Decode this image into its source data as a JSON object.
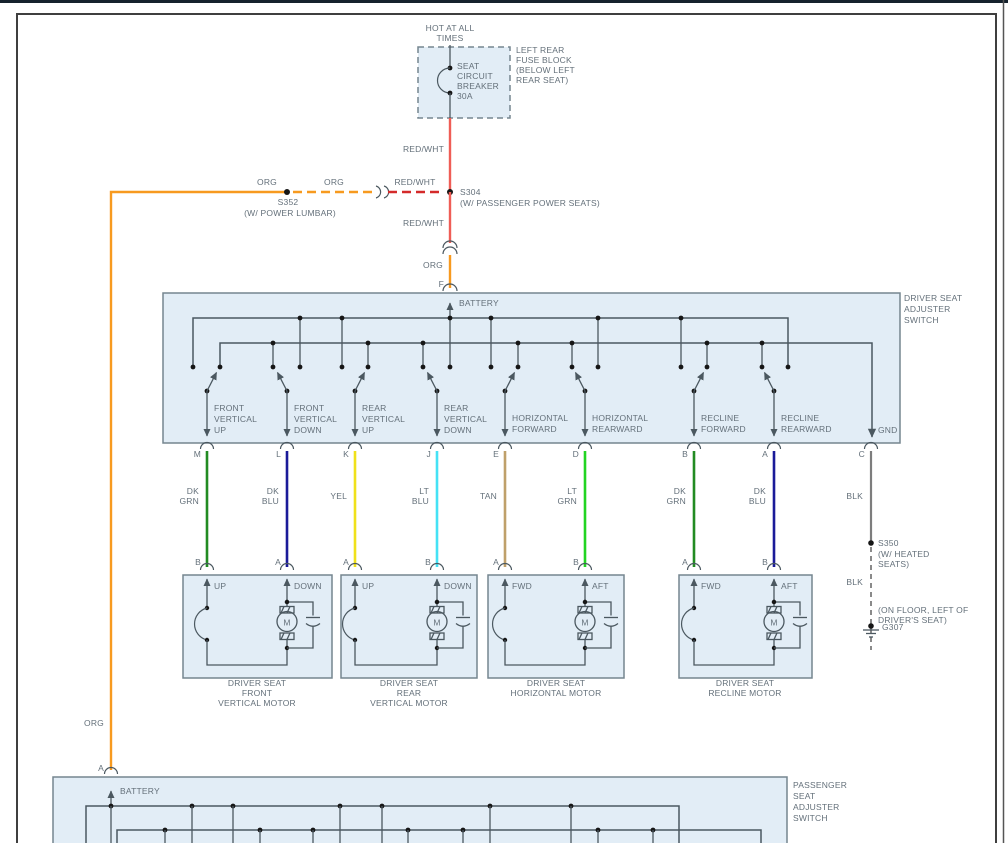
{
  "window": {
    "strip_color": "#15222d",
    "frame_color": "#3f3f3f",
    "edge_color": "#555555"
  },
  "colors": {
    "box_fill": "#e2edf6",
    "box_border": "#75858f",
    "line": "#4b5860",
    "text": "#64707a",
    "red_wht": "#ef5d56",
    "red_wht_dash": "#d42a2a",
    "org": "#f79a1f",
    "dk_grn": "#228b22",
    "dk_blu": "#1a1a99",
    "yel": "#f0e11a",
    "lt_blu": "#45e2f5",
    "tan": "#bfa06a",
    "lt_grn": "#22d422",
    "blk": "#7d7d7d"
  },
  "feed": {
    "hot_lines": [
      "HOT AT ALL",
      "TIMES"
    ],
    "breaker_lines": [
      "SEAT",
      "CIRCUIT",
      "BREAKER",
      "30A"
    ],
    "fuse_block_lines": [
      "LEFT REAR",
      "FUSE BLOCK",
      "(BELOW LEFT",
      "REAR SEAT)"
    ],
    "labels": {
      "red_wht": "RED/WHT",
      "org": "ORG",
      "f_pin": "F"
    }
  },
  "splices": {
    "s352": {
      "id": "S352",
      "note": "(W/ POWER LUMBAR)"
    },
    "s304": {
      "id": "S304",
      "note": "(W/ PASSENGER POWER SEATS)"
    },
    "s350": {
      "id": "S350",
      "note_lines": [
        "(W/ HEATED",
        "SEATS)"
      ]
    },
    "ground": {
      "id": "G307",
      "note_lines": [
        "(ON FLOOR, LEFT OF",
        "DRIVER'S SEAT)"
      ],
      "wire": "BLK"
    }
  },
  "driver_switch": {
    "title_lines": [
      "DRIVER SEAT",
      "ADJUSTER",
      "SWITCH"
    ],
    "battery_label": "BATTERY",
    "gnd_label": "GND",
    "functions": [
      {
        "lines": [
          "FRONT",
          "VERTICAL",
          "UP"
        ]
      },
      {
        "lines": [
          "FRONT",
          "VERTICAL",
          "DOWN"
        ]
      },
      {
        "lines": [
          "REAR",
          "VERTICAL",
          "UP"
        ]
      },
      {
        "lines": [
          "REAR",
          "VERTICAL",
          "DOWN"
        ]
      },
      {
        "lines": [
          "HORIZONTAL",
          "FORWARD"
        ]
      },
      {
        "lines": [
          "HORIZONTAL",
          "REARWARD"
        ]
      },
      {
        "lines": [
          "RECLINE",
          "FORWARD"
        ]
      },
      {
        "lines": [
          "RECLINE",
          "REARWARD"
        ]
      }
    ]
  },
  "wires": [
    {
      "top_pin": "M",
      "color_lines": [
        "DK",
        "GRN"
      ],
      "hex": "#228b22",
      "bottom_pin": "B"
    },
    {
      "top_pin": "L",
      "color_lines": [
        "DK",
        "BLU"
      ],
      "hex": "#1a1a99",
      "bottom_pin": "A"
    },
    {
      "top_pin": "K",
      "color_lines": [
        "YEL"
      ],
      "hex": "#f0e11a",
      "bottom_pin": "A"
    },
    {
      "top_pin": "J",
      "color_lines": [
        "LT",
        "BLU"
      ],
      "hex": "#45e2f5",
      "bottom_pin": "B"
    },
    {
      "top_pin": "E",
      "color_lines": [
        "TAN"
      ],
      "hex": "#bfa06a",
      "bottom_pin": "A"
    },
    {
      "top_pin": "D",
      "color_lines": [
        "LT",
        "GRN"
      ],
      "hex": "#22d422",
      "bottom_pin": "B"
    },
    {
      "top_pin": "B",
      "color_lines": [
        "DK",
        "GRN"
      ],
      "hex": "#228b22",
      "bottom_pin": "A"
    },
    {
      "top_pin": "A",
      "color_lines": [
        "DK",
        "BLU"
      ],
      "hex": "#1a1a99",
      "bottom_pin": "B"
    },
    {
      "top_pin": "C",
      "color_lines": [
        "BLK"
      ],
      "hex": "#7d7d7d",
      "bottom_pin": ""
    }
  ],
  "motors": [
    {
      "left_label": "UP",
      "right_label": "DOWN",
      "motor_letter": "M",
      "caption_lines": [
        "DRIVER SEAT",
        "FRONT",
        "VERTICAL MOTOR"
      ]
    },
    {
      "left_label": "UP",
      "right_label": "DOWN",
      "motor_letter": "M",
      "caption_lines": [
        "DRIVER SEAT",
        "REAR",
        "VERTICAL MOTOR"
      ]
    },
    {
      "left_label": "FWD",
      "right_label": "AFT",
      "motor_letter": "M",
      "caption_lines": [
        "DRIVER SEAT",
        "HORIZONTAL MOTOR"
      ]
    },
    {
      "left_label": "FWD",
      "right_label": "AFT",
      "motor_letter": "M",
      "caption_lines": [
        "DRIVER SEAT",
        "RECLINE MOTOR"
      ]
    }
  ],
  "passenger_switch": {
    "title_lines": [
      "PASSENGER",
      "SEAT",
      "ADJUSTER",
      "SWITCH"
    ],
    "battery_label": "BATTERY",
    "pin": "A",
    "feed_wire": "ORG"
  }
}
